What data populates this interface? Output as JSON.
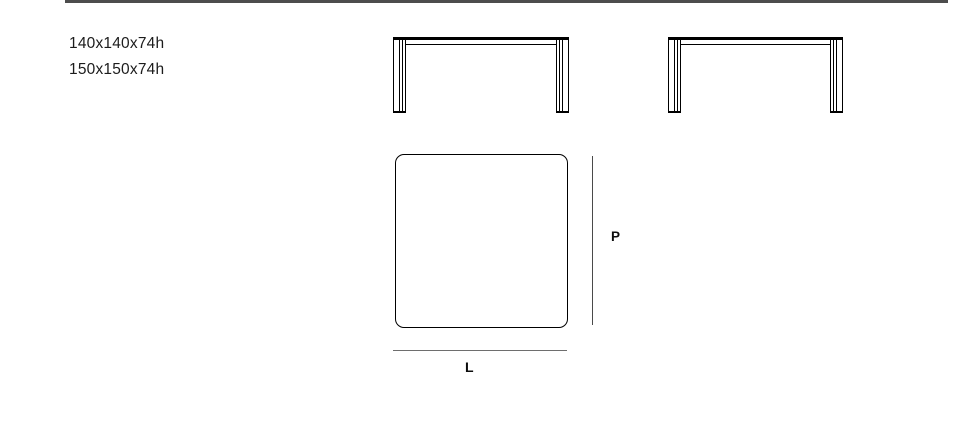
{
  "sizes": {
    "items": [
      "140x140x74h",
      "150x150x74h"
    ]
  },
  "diagram": {
    "depth_label": "P",
    "length_label": "L"
  },
  "icons": {
    "front_view": "table-front-elevation",
    "top_view": "tabletop-top-view"
  },
  "colors": {
    "rule": "#4d4d4d",
    "text": "#1c1c1c",
    "drawing": "#000000"
  }
}
